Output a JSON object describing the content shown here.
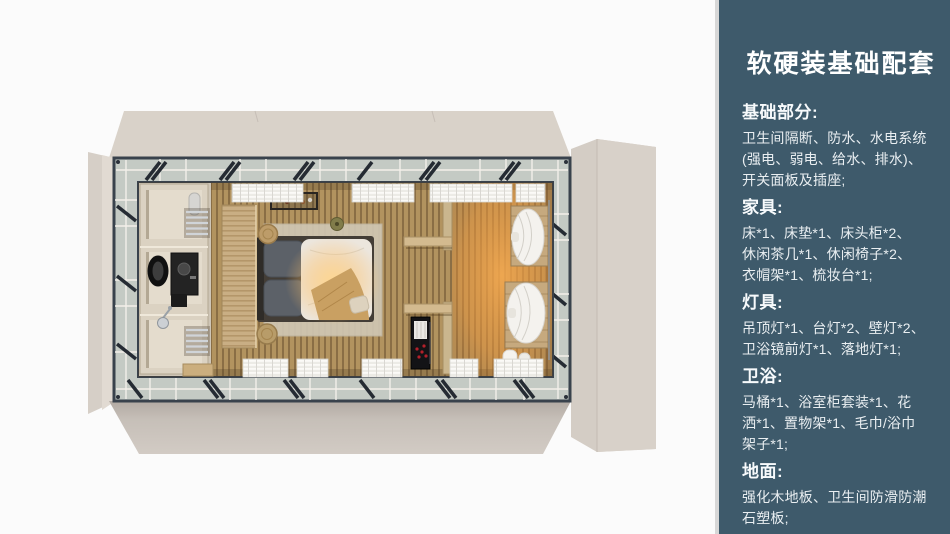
{
  "page": {
    "background": "#fbfbfb"
  },
  "sidebar": {
    "background": "#3e5a6b",
    "edge_strip_color": "#d7d7d7",
    "text_color": "#ffffff",
    "title": "软硬装基础配套",
    "sections": [
      {
        "heading": "基础部分:",
        "lines": [
          "卫生间隔断、防水、水电系统",
          "(强电、弱电、给水、排水)、",
          "开关面板及插座;"
        ]
      },
      {
        "heading": "家具:",
        "lines": [
          "床*1、床垫*1、床头柜*2、",
          "休闲茶几*1、休闲椅子*2、",
          "衣帽架*1、梳妆台*1;"
        ]
      },
      {
        "heading": "灯具:",
        "lines": [
          "吊顶灯*1、台灯*2、壁灯*2、",
          "卫浴镜前灯*1、落地灯*1;"
        ]
      },
      {
        "heading": "卫浴:",
        "lines": [
          "马桶*1、浴室柜套装*1、花",
          "洒*1、置物架*1、毛巾/浴巾",
          "架子*1;"
        ]
      },
      {
        "heading": "地面:",
        "lines": [
          "强化木地板、卫生间防滑防潮",
          "石塑板;"
        ]
      }
    ]
  },
  "floorplan": {
    "colors": {
      "flap": "#d9d2c9",
      "flap_shadow": "#b2aaa3",
      "frame": "#39424c",
      "glass_band": "#c4cac4",
      "mullion": "#f3f0ea",
      "floor_wood": "#b2935f",
      "floor_stripe": "#8a6e45",
      "warm_glow": "#f0a04e",
      "bathroom_wall": "#dbd2c2",
      "wood_partition": "#c9ae84",
      "bed_frame": "#433d36",
      "pillow": "#5c6168",
      "duvet": "#ece6dd",
      "throw_blanket": "#c9a062",
      "rug": "#d0c6b3",
      "curtain": "#f4f2ee",
      "cabinet_black": "#131316"
    }
  }
}
